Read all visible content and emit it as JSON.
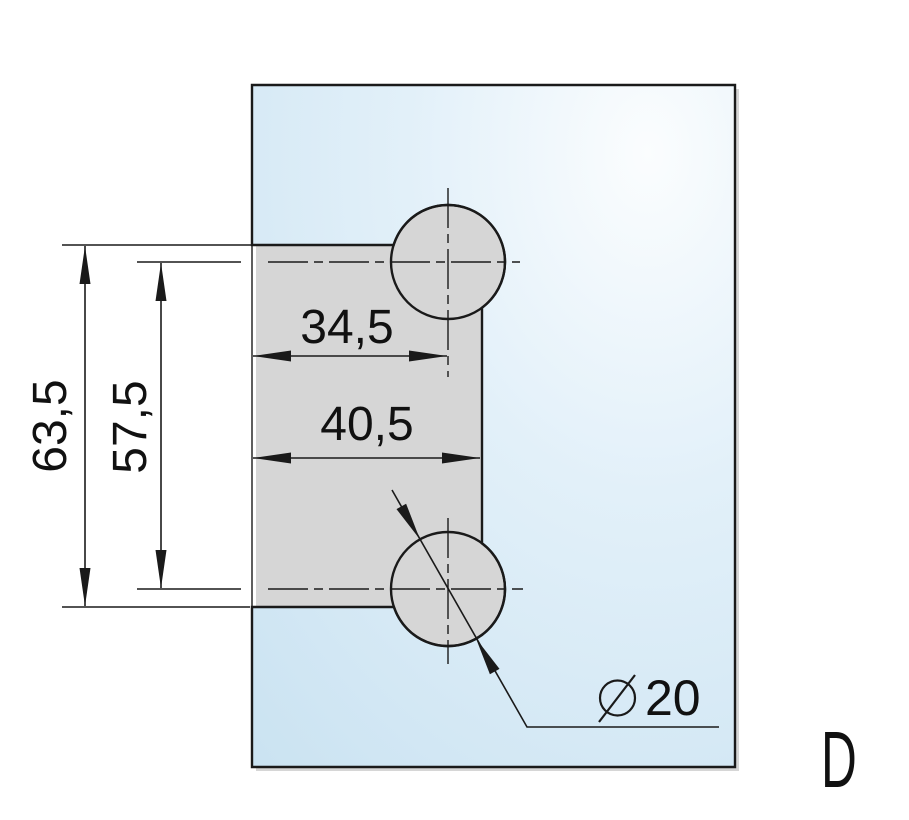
{
  "drawing": {
    "type": "glass-panel-hinge-cutout-dimension-drawing",
    "variant_label": "D",
    "dimensions": {
      "edge_to_hole_center_width": "34,5",
      "notch_depth_width": "40,5",
      "notch_total_height": "63,5",
      "hole_center_spacing": "57,5",
      "hole_diameter_value": "20"
    },
    "colors": {
      "line": "#1a1a1a",
      "text": "#111111",
      "glass_highlight": "#fbfdfe",
      "glass_mid": "#e2f0f9",
      "glass_deep": "#c9e2f1",
      "shadow": "#b5b5b5",
      "background": "#ffffff"
    }
  }
}
